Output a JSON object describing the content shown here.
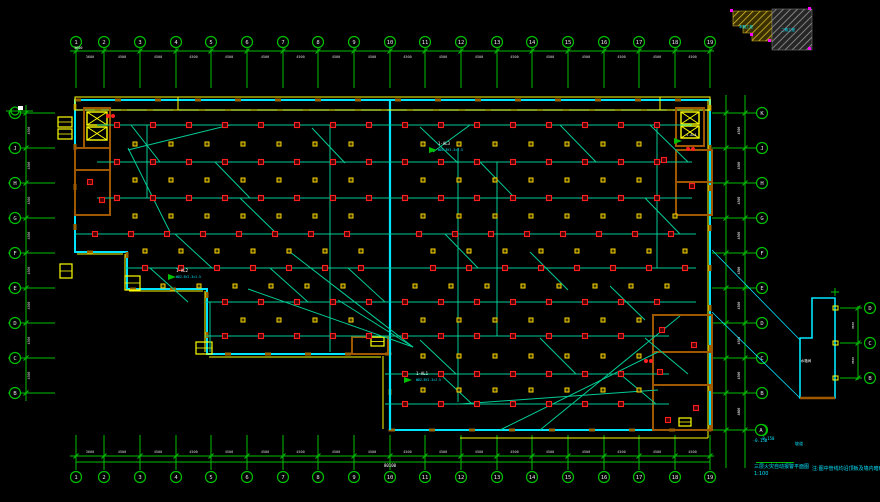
{
  "drawing_title": "三层火灾自动报警平面图",
  "canvas": {
    "width": 880,
    "height": 502,
    "bg": "#000000"
  },
  "colors": {
    "grid": "#00c000",
    "circle_label": "#e8e8e8",
    "dim_text": "#d8d8d8",
    "wall": "#00e5ff",
    "wall_dash": "#9a6400",
    "wall_outer": "#ffff00",
    "core_wall": "#a05800",
    "panel": "#ffff00",
    "wire": "#00cc96",
    "device_red": "#ff1f1f",
    "device_red_fill": "#4d0000",
    "device_yellow": "#ffd700",
    "device_yellow_fill": "#3f3a00",
    "magenta": "#ff00ff",
    "white": "#ffffff",
    "cyan": "#00e5ff",
    "keyplan_yellow": "#d8b92a",
    "keyplan_gray": "#9a9a9a"
  },
  "grid": {
    "top": {
      "labels": [
        "1",
        "2",
        "3",
        "4",
        "5",
        "6",
        "7",
        "8",
        "9",
        "10",
        "11",
        "12",
        "13",
        "14",
        "15",
        "16",
        "17",
        "18",
        "19"
      ],
      "xs": [
        76,
        104,
        140,
        176,
        211,
        247,
        283,
        318,
        354,
        390,
        425,
        461,
        497,
        532,
        568,
        604,
        639,
        675,
        710
      ],
      "circle_y": 42,
      "line_y1": 48,
      "line_y2": 88,
      "dim_line_y": 51,
      "dim_text_y": 56,
      "dims": [
        "3600",
        "4500",
        "4500",
        "4500",
        "4500",
        "4500",
        "4500",
        "4500",
        "4500",
        "4500",
        "4500",
        "4500",
        "4500",
        "4500",
        "4500",
        "4500",
        "4500",
        "4500"
      ]
    },
    "bottom": {
      "labels": [
        "1",
        "2",
        "3",
        "4",
        "5",
        "6",
        "7",
        "8",
        "9",
        "10",
        "11",
        "12",
        "13",
        "14",
        "15",
        "16",
        "17",
        "18",
        "19"
      ],
      "xs": [
        76,
        104,
        140,
        176,
        211,
        247,
        283,
        318,
        354,
        390,
        425,
        461,
        497,
        532,
        568,
        604,
        639,
        675,
        710
      ],
      "circle_y": 477,
      "line_y1": 435,
      "line_y2": 470,
      "dim_line_y": 456,
      "dim_text_y": 453,
      "axis_line_y": 462,
      "total_dim": "80100",
      "total_x": 390,
      "total_y": 467,
      "dims": [
        "3600",
        "4500",
        "4500",
        "4500",
        "4500",
        "4500",
        "4500",
        "4500",
        "4500",
        "4500",
        "4500",
        "4500",
        "4500",
        "4500",
        "4500",
        "4500",
        "4500",
        "4500"
      ]
    },
    "left": {
      "labels": [
        "K",
        "J",
        "H",
        "G",
        "F",
        "E",
        "D",
        "C",
        "B"
      ],
      "ys": [
        113,
        148,
        183,
        218,
        253,
        288,
        323,
        358,
        393
      ],
      "circle_x": 15,
      "line_x1": 8,
      "line_x2": 55,
      "trunk_x": 26,
      "dim_x": 30,
      "dims": [
        "4500",
        "4500",
        "4500",
        "4500",
        "4500",
        "4500",
        "4500",
        "4500"
      ]
    },
    "right": {
      "labels": [
        "K",
        "J",
        "H",
        "G",
        "F",
        "E",
        "D",
        "C",
        "B",
        "A"
      ],
      "ys": [
        113,
        148,
        183,
        218,
        253,
        288,
        323,
        358,
        393,
        430
      ],
      "circle_x": 762,
      "line_x1": 712,
      "line_x2": 757,
      "trunk_x1": 726,
      "trunk_x2": 745,
      "dim_x": 740,
      "dims": [
        "4500",
        "4500",
        "4500",
        "4500",
        "4500",
        "4500",
        "4500",
        "4500",
        "4800"
      ]
    },
    "detail_axes": {
      "labels": [
        "D",
        "C",
        "B"
      ],
      "ys": [
        308,
        343,
        378
      ],
      "circle_x": 870,
      "line_x1": 840,
      "line_x2": 862,
      "trunk_x": 858,
      "dim_x": 854,
      "dims": [
        "4500",
        "4500"
      ]
    },
    "datum": {
      "x": 761,
      "y": 430,
      "label": "A",
      "elevation": "-0.150"
    }
  },
  "plan": {
    "outline": [
      [
        75,
        100
      ],
      [
        710,
        100
      ],
      [
        710,
        430
      ],
      [
        390,
        430
      ],
      [
        390,
        354
      ],
      [
        207,
        354
      ],
      [
        207,
        289
      ],
      [
        127,
        289
      ],
      [
        127,
        252
      ],
      [
        75,
        252
      ]
    ],
    "inner_top_dash_y": 110,
    "divider": [
      [
        390,
        100
      ],
      [
        390,
        430
      ]
    ],
    "top_band": {
      "x1": 75,
      "y1": 97,
      "x2": 710,
      "y2": 110,
      "dividers": [
        178,
        660
      ]
    },
    "yellow_lines": [
      [
        708,
        100,
        708,
        438
      ],
      [
        460,
        438,
        708,
        438
      ],
      [
        383,
        356,
        383,
        429
      ],
      [
        209,
        357,
        381,
        357
      ],
      [
        205,
        291,
        205,
        352
      ],
      [
        129,
        291,
        203,
        291
      ],
      [
        125,
        254,
        125,
        287
      ],
      [
        77,
        254,
        123,
        254
      ]
    ],
    "core_rects": [
      [
        84,
        108,
        26,
        40
      ],
      [
        75,
        148,
        35,
        22
      ],
      [
        75,
        170,
        35,
        45
      ],
      [
        676,
        108,
        28,
        38
      ],
      [
        676,
        150,
        36,
        32
      ],
      [
        676,
        182,
        36,
        33
      ],
      [
        653,
        315,
        59,
        37
      ],
      [
        653,
        352,
        59,
        33
      ],
      [
        653,
        385,
        59,
        45
      ],
      [
        352,
        337,
        36,
        17
      ]
    ],
    "shaft_boxes": [
      [
        87,
        112,
        20,
        13
      ],
      [
        87,
        127,
        20,
        13
      ],
      [
        681,
        112,
        18,
        12
      ],
      [
        681,
        126,
        18,
        12
      ]
    ],
    "panels": [
      [
        58,
        117,
        14,
        10
      ],
      [
        58,
        129,
        14,
        10
      ],
      [
        60,
        264,
        12,
        14
      ],
      [
        125,
        276,
        15,
        14
      ],
      [
        196,
        342,
        16,
        12
      ],
      [
        371,
        337,
        13,
        9
      ],
      [
        679,
        418,
        12,
        8
      ]
    ],
    "devices": {
      "spacing": 36,
      "yellow_offset": 18,
      "divider_gap": 12,
      "red_rows": [
        {
          "y": 125,
          "x0": 117,
          "x1": 668
        },
        {
          "y": 162,
          "x0": 117,
          "x1": 668
        },
        {
          "y": 198,
          "x0": 117,
          "x1": 668
        },
        {
          "y": 234,
          "x0": 95,
          "x1": 692
        },
        {
          "y": 268,
          "x0": 145,
          "x1": 692
        },
        {
          "y": 302,
          "x0": 225,
          "x1": 692
        },
        {
          "y": 336,
          "x0": 225,
          "x1": 645
        },
        {
          "y": 374,
          "x0": 405,
          "x1": 645
        },
        {
          "y": 404,
          "x0": 405,
          "x1": 645
        }
      ],
      "yellow_rows": [
        {
          "y": 144,
          "x0": 135,
          "x1": 650
        },
        {
          "y": 180,
          "x0": 135,
          "x1": 650
        },
        {
          "y": 216,
          "x0": 135,
          "x1": 686
        },
        {
          "y": 251,
          "x0": 145,
          "x1": 686
        },
        {
          "y": 286,
          "x0": 163,
          "x1": 686
        },
        {
          "y": 320,
          "x0": 243,
          "x1": 640
        },
        {
          "y": 356,
          "x0": 423,
          "x1": 640
        },
        {
          "y": 390,
          "x0": 423,
          "x1": 640
        }
      ],
      "single_red": [
        [
          90,
          182
        ],
        [
          102,
          200
        ],
        [
          664,
          160
        ],
        [
          692,
          186
        ],
        [
          662,
          330
        ],
        [
          694,
          345
        ],
        [
          660,
          372
        ],
        [
          696,
          408
        ],
        [
          668,
          420
        ]
      ],
      "exit_pairs": [
        [
          110,
          116
        ],
        [
          690,
          149
        ],
        [
          648,
          361
        ]
      ]
    },
    "wires": {
      "verticals": [
        [
          147,
          125,
          198
        ],
        [
          330,
          125,
          352
        ],
        [
          458,
          148,
          402
        ],
        [
          657,
          125,
          268
        ],
        [
          497,
          162,
          336
        ],
        [
          210,
          302,
          352
        ]
      ],
      "diagonals": [
        [
          131,
          125,
          160,
          162
        ],
        [
          312,
          128,
          345,
          163
        ],
        [
          420,
          127,
          458,
          163
        ],
        [
          560,
          125,
          596,
          162
        ],
        [
          650,
          125,
          688,
          162
        ],
        [
          215,
          162,
          250,
          198
        ],
        [
          480,
          162,
          515,
          198
        ],
        [
          240,
          198,
          277,
          234
        ],
        [
          645,
          198,
          680,
          234
        ],
        [
          175,
          234,
          212,
          268
        ],
        [
          445,
          234,
          478,
          268
        ],
        [
          530,
          252,
          568,
          290
        ],
        [
          610,
          286,
          645,
          320
        ],
        [
          150,
          268,
          188,
          302
        ],
        [
          270,
          268,
          308,
          302
        ],
        [
          348,
          268,
          385,
          302
        ],
        [
          420,
          340,
          456,
          374
        ],
        [
          540,
          338,
          576,
          374
        ],
        [
          645,
          338,
          688,
          374
        ],
        [
          440,
          374,
          472,
          404
        ],
        [
          620,
          374,
          656,
          404
        ],
        [
          290,
          252,
          413,
          347
        ],
        [
          338,
          300,
          413,
          347
        ],
        [
          248,
          289,
          413,
          347
        ],
        [
          500,
          430,
          658,
          352
        ],
        [
          540,
          430,
          680,
          316
        ],
        [
          460,
          404,
          658,
          390
        ],
        [
          128,
          148,
          170,
          232
        ],
        [
          128,
          150,
          230,
          125
        ],
        [
          433,
          152,
          470,
          125
        ]
      ],
      "leaders": [
        [
          712,
          250,
          800,
          340
        ],
        [
          712,
          312,
          800,
          398
        ]
      ]
    },
    "hydrant_triangles": [
      [
        433,
        150
      ],
      [
        172,
        277
      ],
      [
        408,
        380
      ],
      [
        678,
        141
      ]
    ]
  },
  "detail": {
    "outline": [
      [
        812,
        298
      ],
      [
        835,
        298
      ],
      [
        835,
        398
      ],
      [
        800,
        398
      ],
      [
        800,
        338
      ],
      [
        812,
        338
      ]
    ],
    "bottom_wall": [
      800,
      398,
      835,
      398
    ],
    "ticks": [
      [
        833,
        306
      ],
      [
        833,
        341
      ],
      [
        833,
        376
      ]
    ],
    "plus_mark": [
      835,
      292
    ],
    "label": {
      "x": 806,
      "y": 362,
      "text": "水箱间"
    }
  },
  "keyplan": {
    "yellow_poly": [
      [
        733,
        11
      ],
      [
        772,
        11
      ],
      [
        772,
        41
      ],
      [
        752,
        41
      ],
      [
        752,
        33
      ],
      [
        743,
        33
      ],
      [
        743,
        26
      ],
      [
        733,
        26
      ]
    ],
    "gray_rect": [
      772,
      9,
      40,
      41
    ],
    "magenta_ticks": [
      [
        730,
        9
      ],
      [
        808,
        7
      ],
      [
        808,
        47
      ],
      [
        768,
        39
      ],
      [
        750,
        33
      ]
    ],
    "labels": [
      {
        "x": 746,
        "y": 28,
        "text": "本期工程"
      },
      {
        "x": 788,
        "y": 31,
        "text": "二期工程"
      }
    ]
  },
  "annotations": [
    {
      "x": 438,
      "y": 145,
      "text": "1-AL3",
      "color": "#ffffff",
      "size": 4
    },
    {
      "x": 438,
      "y": 151,
      "text": "WDZ-BYJ-3×2.5",
      "color": "#00e5ff",
      "size": 3.2
    },
    {
      "x": 176,
      "y": 272,
      "text": "1-AL2",
      "color": "#ffffff",
      "size": 4
    },
    {
      "x": 176,
      "y": 278,
      "text": "WDZ-BYJ-3×2.5",
      "color": "#00e5ff",
      "size": 3.2
    },
    {
      "x": 416,
      "y": 375,
      "text": "1-AL1",
      "color": "#ffffff",
      "size": 4
    },
    {
      "x": 416,
      "y": 381,
      "text": "WDZ-BYJ-3×2.5",
      "color": "#00e5ff",
      "size": 3.2
    },
    {
      "x": 686,
      "y": 136,
      "text": "1-AL4",
      "color": "#ffffff",
      "size": 3.5
    },
    {
      "x": 760,
      "y": 440,
      "text": "-0.150",
      "color": "#00e5ff",
      "size": 4
    },
    {
      "x": 795,
      "y": 445,
      "text": "坡道",
      "color": "#00e5ff",
      "size": 4
    },
    {
      "x": 74,
      "y": 49,
      "text": "3600",
      "color": "#ffffff",
      "size": 3.5
    }
  ],
  "titles": {
    "main": "三层火灾自动报警平面图",
    "scale": "1:100",
    "note": "注:图中管线均沿顶板及墙内暗敷设"
  }
}
